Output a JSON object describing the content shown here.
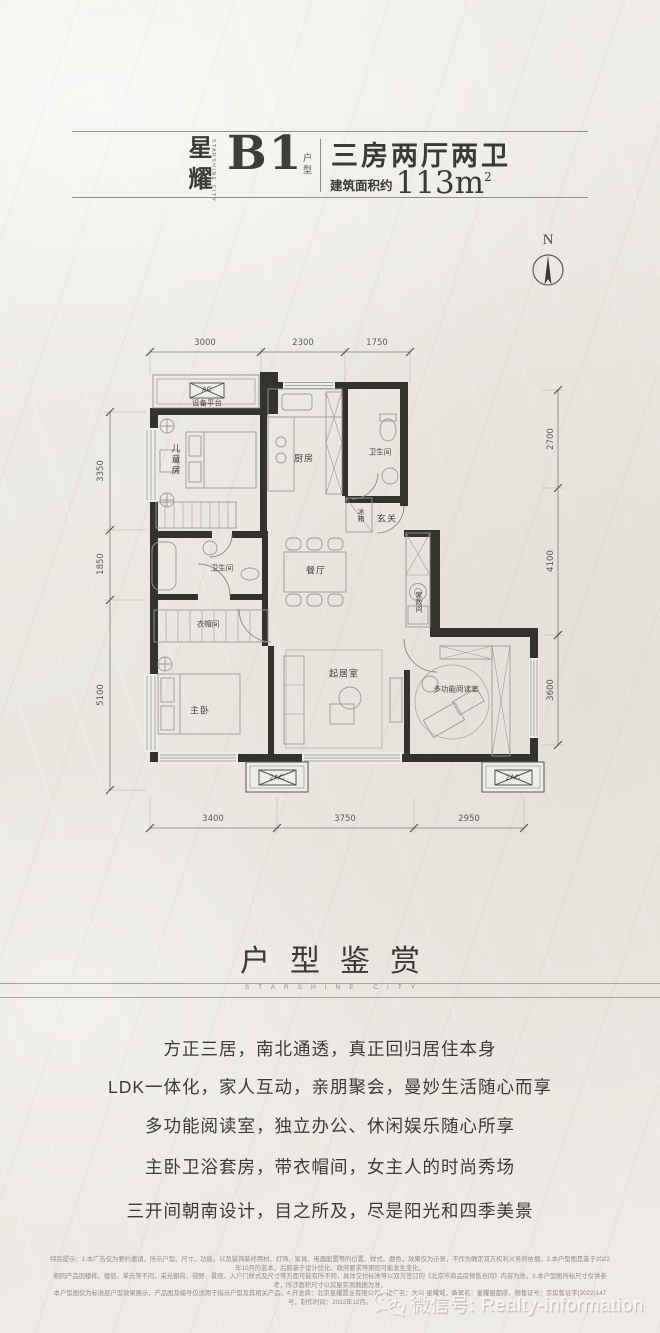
{
  "header": {
    "brand_cn": "星耀",
    "brand_en": "STARSHINE CITY",
    "unit": "B1",
    "unit_suffix": "户型",
    "layout": "三房两厅两卫",
    "area_prefix": "建筑面积约",
    "area_value": "113m",
    "area_sup": "2"
  },
  "compass": {
    "label": "N"
  },
  "plan": {
    "dims": {
      "top": [
        "3000",
        "2300",
        "1750"
      ],
      "bottom": [
        "3400",
        "3750",
        "2950"
      ],
      "left": [
        "3350",
        "1850",
        "5100"
      ],
      "right": [
        "2700",
        "4100",
        "3600"
      ]
    },
    "rooms": {
      "equipment": "设备平台",
      "ac": "AC",
      "kids": "儿童房",
      "kitchen": "厨房",
      "fridge": "冰箱",
      "bath1": "卫生间",
      "foyer": "玄关",
      "dining": "餐厅",
      "bath2": "卫生间",
      "cloak": "衣帽间",
      "master": "主卧",
      "living": "起居室",
      "housework": "家政间",
      "reading": "多功能阅读室",
      "ac2_left": "2AC",
      "ac2_right": "2AC"
    }
  },
  "showcase": {
    "title": "户型鉴赏",
    "subtitle": "STARSHINE CITY",
    "features": [
      "方正三居，南北通透，真正回归居住本身",
      "LDK一体化，家人互动，亲朋聚会，曼妙生活随心而享",
      "多功能阅读室，独立办公、休闲娱乐随心所享",
      "主卧卫浴套房，带衣帽间，女主人的时尚秀场",
      "三开间朝南设计，目之所及，尽是阳光和四季美景"
    ]
  },
  "disclaimer": {
    "line1": "特别提示：1.本广告仅为要约邀请，所示户型、尺寸、功能，以及装饰装修用材、灯饰、家具、电器配置等的位置、样式、颜色，效果仅为示意，不作为确定双方权利义务的依据。2.本户型图是基于2022年10月的蓝本，后期基于设计优化、政府要求等原因可能发生变化，",
    "line2": "相同产品因楼栋、楼层、单元等不同，采光朝向、视野、景观、入户门样式及尺寸等方面可能有所不同，具体交付标准等以双方签订的《北京市商品房预售合同》内容为准。3.本户型图所标尺寸仅供参考，所涉面积尺寸以房屋实测数据为准，",
    "line3": "本户型图仅为标准层户型效果展示，产品图及编号仅适用于指示户型及其相关产品。4.开发商：北京星耀置业有限公司，推广名：大兴·星耀城，备案名：星耀丽都府，预售证号：京房售证字(2022)147号，制作时间：2022年12月。"
  },
  "watermark": {
    "label": "微信号: Realty-information"
  }
}
